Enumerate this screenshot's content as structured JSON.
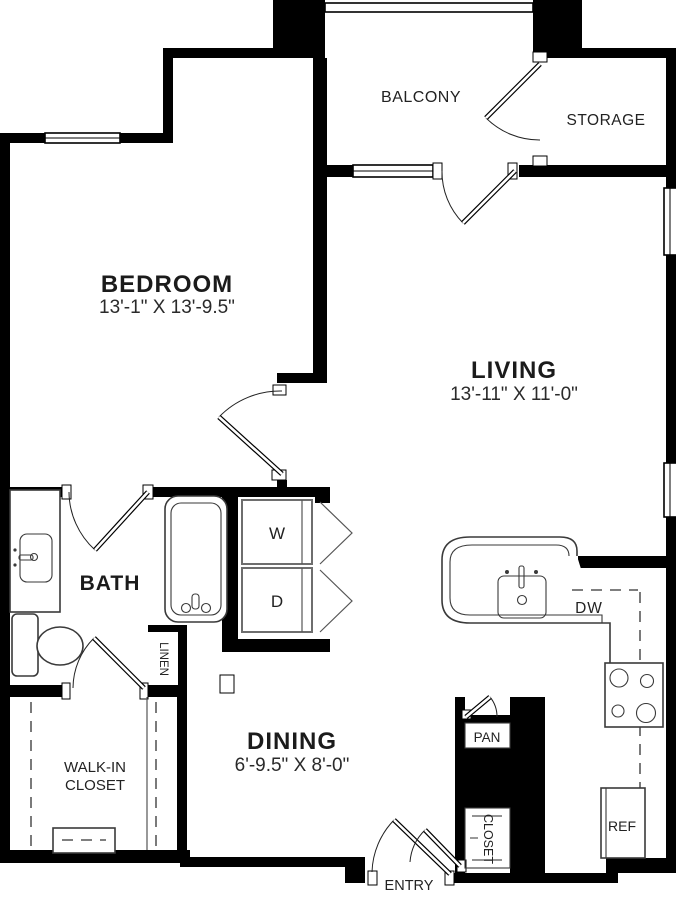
{
  "floor_plan": {
    "rooms": {
      "bedroom": {
        "label": "BEDROOM",
        "dims": "13'-1\" X 13'-9.5\""
      },
      "living": {
        "label": "LIVING",
        "dims": "13'-11\" X 11'-0\""
      },
      "dining": {
        "label": "DINING",
        "dims": "6'-9.5\" X 8'-0\""
      },
      "balcony": {
        "label": "BALCONY"
      },
      "storage": {
        "label": "STORAGE"
      },
      "bath": {
        "label": "BATH"
      },
      "walk_in_closet": {
        "label_line1": "WALK-IN",
        "label_line2": "CLOSET"
      },
      "linen": {
        "label": "LINEN"
      },
      "pantry": {
        "label": "PAN"
      },
      "entry_closet": {
        "label": "CLOSET"
      },
      "entry": {
        "label": "ENTRY"
      }
    },
    "appliances": {
      "washer": "W",
      "dryer": "D",
      "dishwasher": "DW",
      "refrigerator": "REF"
    },
    "colors": {
      "wall": "#000000",
      "background": "#ffffff",
      "fixture_outline": "#3a3a3a"
    }
  }
}
